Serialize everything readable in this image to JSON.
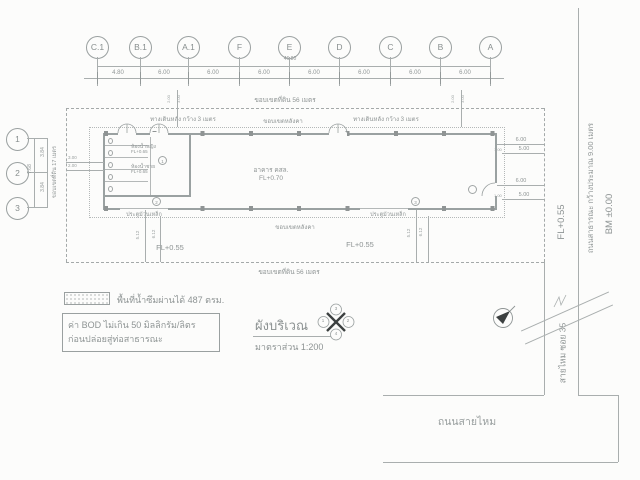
{
  "title": {
    "name": "ผังบริเวณ",
    "scale": "มาตราส่วน  1:200"
  },
  "grid_top": {
    "labels": [
      "C.1",
      "B.1",
      "A.1",
      "F",
      "E",
      "D",
      "C",
      "B",
      "A"
    ],
    "dims": [
      "4.80",
      "6.00",
      "6.00",
      "6.00",
      "6.00",
      "6.00",
      "6.00",
      "6.00"
    ],
    "total": "46.80"
  },
  "grid_left": {
    "labels": [
      "1",
      "2",
      "3"
    ],
    "dims": [
      "3.84",
      "3.84"
    ],
    "total": "7.68"
  },
  "boundary": {
    "top": "ขอบเขตที่ดิน 56 เมตร",
    "bottom": "ขอบเขตที่ดิน 56 เมตร",
    "left": "ขอบเขตที่ดิน 17 เมตร"
  },
  "walkway": {
    "left": "ทางเดินหลัง กว้าง 3 เมตร",
    "right": "ทางเดินหลัง กว้าง 3 เมตร"
  },
  "roof": {
    "top": "ขอบเขตหลังคา",
    "bottom": "ขอบเขตหลังคา"
  },
  "building": {
    "name": "อาคาร คสล.",
    "level": "FL+0.70",
    "toilet_women": "ห้องน้ำหญิง",
    "toilet_women_level": "FL+0.65",
    "toilet_men": "ห้องน้ำชาย",
    "toilet_men_level": "FL+0.65",
    "rolling_door_left": "ประตูม้วนเหล็ก",
    "rolling_door_right": "ประตูม้วนเหล็ก"
  },
  "yard": {
    "fl_left": "FL+0.55",
    "fl_right": "FL+0.55"
  },
  "dims": {
    "right": [
      "6.00",
      "5.00",
      "6.00",
      "5.00"
    ],
    "right_small": [
      "1.00",
      "1.00"
    ],
    "yard": [
      "5.12",
      "6.12",
      "5.12",
      "6.12"
    ],
    "left_small": [
      "3.00",
      "2.00"
    ],
    "top_small": [
      "2.00",
      "3.00",
      "2.00",
      "3.00"
    ]
  },
  "roadside": {
    "fl": "FL+0.55",
    "bm": "BM ±0.00",
    "road_vertical": "ถนนสาธารณะ กว้างประมาณ 9.00 เมตร",
    "soi": "สายไหม ซอย 35",
    "road_bottom": "ถนนสายไหม"
  },
  "legend": {
    "permeable": "พื้นที่น้ำซึมผ่านได้ 487 ตรม.",
    "bod_line1": "ค่า BOD ไม่เกิน 50 มิลลิกรัม/ลิตร",
    "bod_line2": "ก่อนปล่อยสู่ท่อสาธารณะ"
  },
  "elevation_marker": {
    "left": "1",
    "right": "2",
    "top": "3",
    "bottom": "4"
  },
  "door_tags": [
    "1",
    "2",
    "3"
  ],
  "colors": {
    "line": "#a9aeae",
    "text": "#8e9494"
  }
}
